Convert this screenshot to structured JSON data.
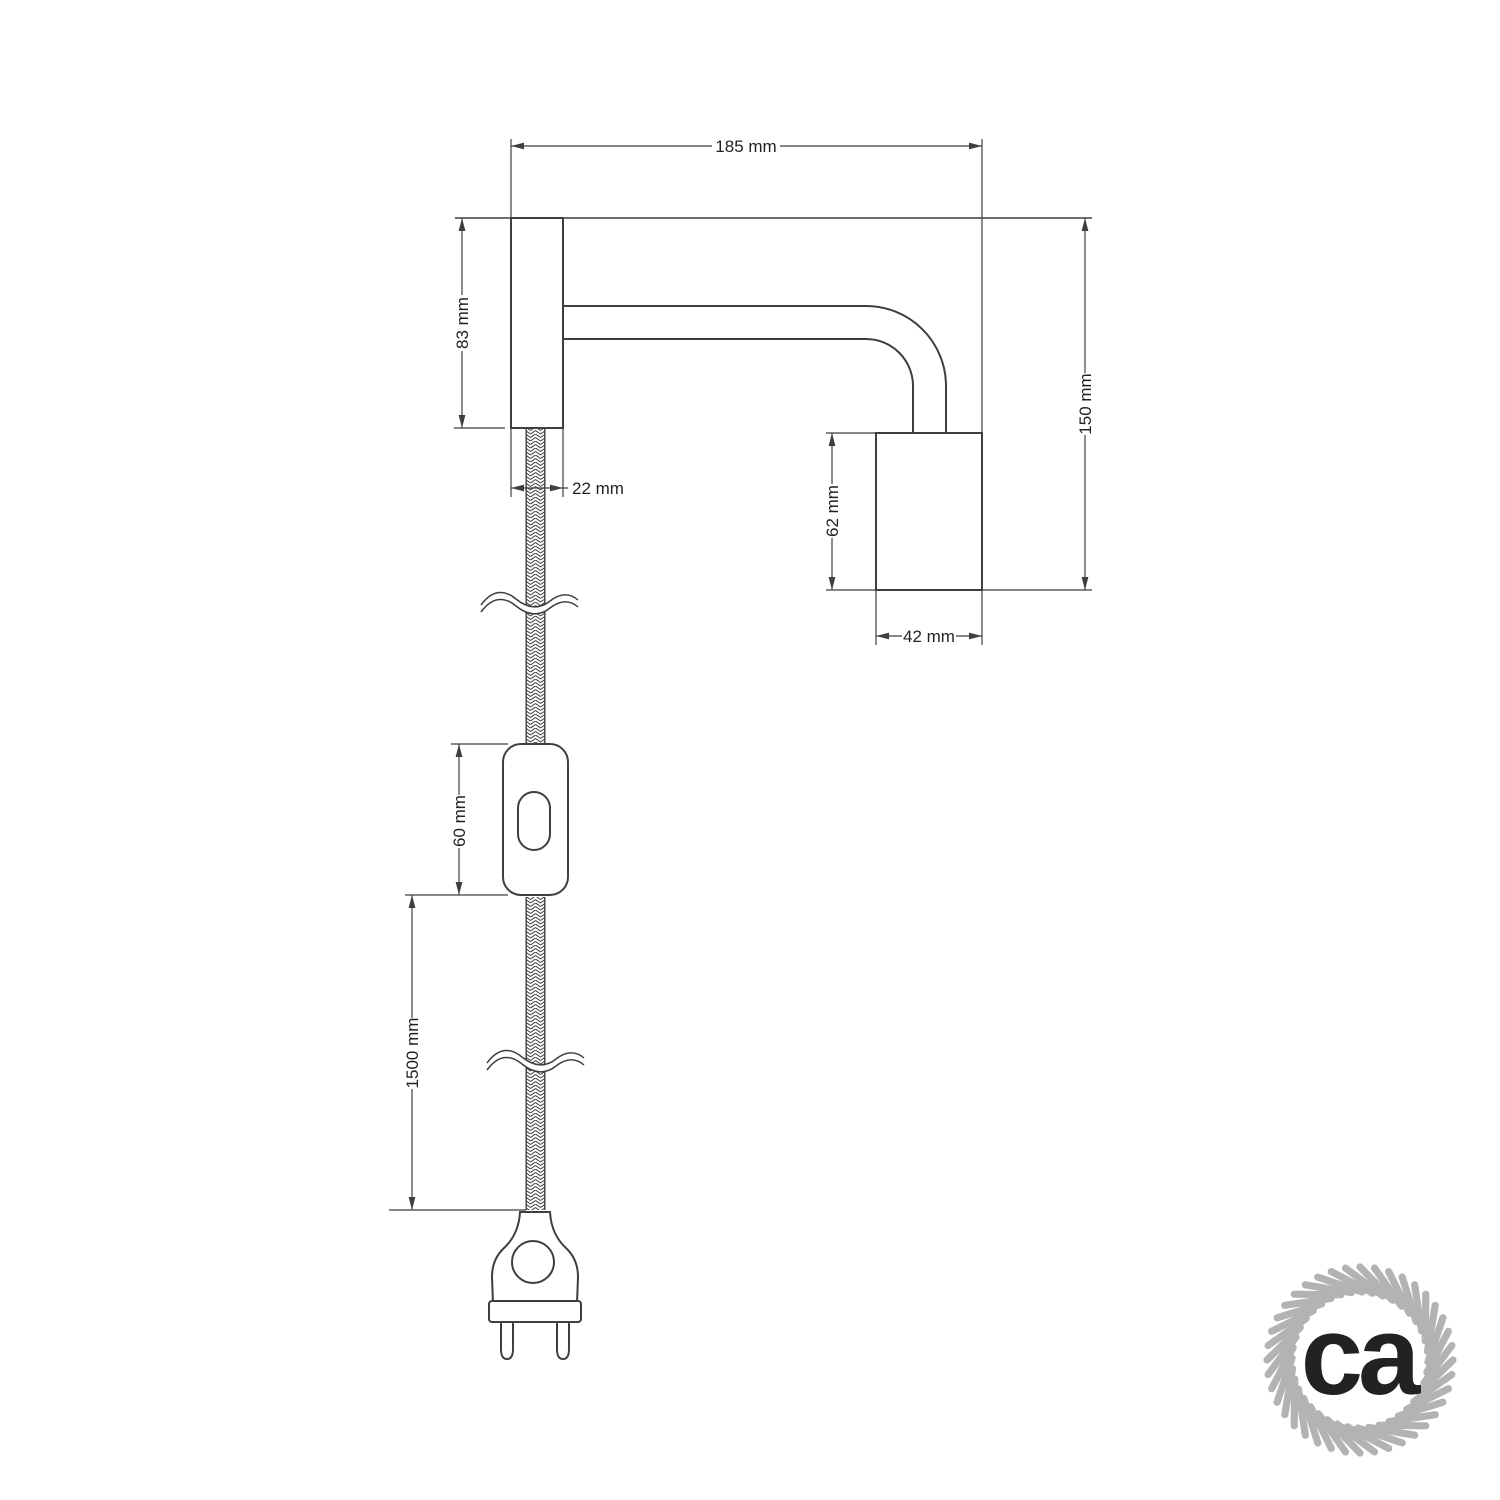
{
  "drawing": {
    "line_color": "#3f3f3f",
    "dim_line_color": "#3f3f3f",
    "text_color": "#222222",
    "braid_color": "#3a3a3a",
    "background": "#ffffff"
  },
  "dims": {
    "total_width": "185 mm",
    "plate_height": "83 mm",
    "plate_width": "22 mm",
    "total_height": "150 mm",
    "socket_height": "62 mm",
    "socket_width": "42 mm",
    "switch_length": "60 mm",
    "cable_length": "1500 mm"
  },
  "logo": {
    "text": "ca",
    "color": "#b3b3b3"
  }
}
